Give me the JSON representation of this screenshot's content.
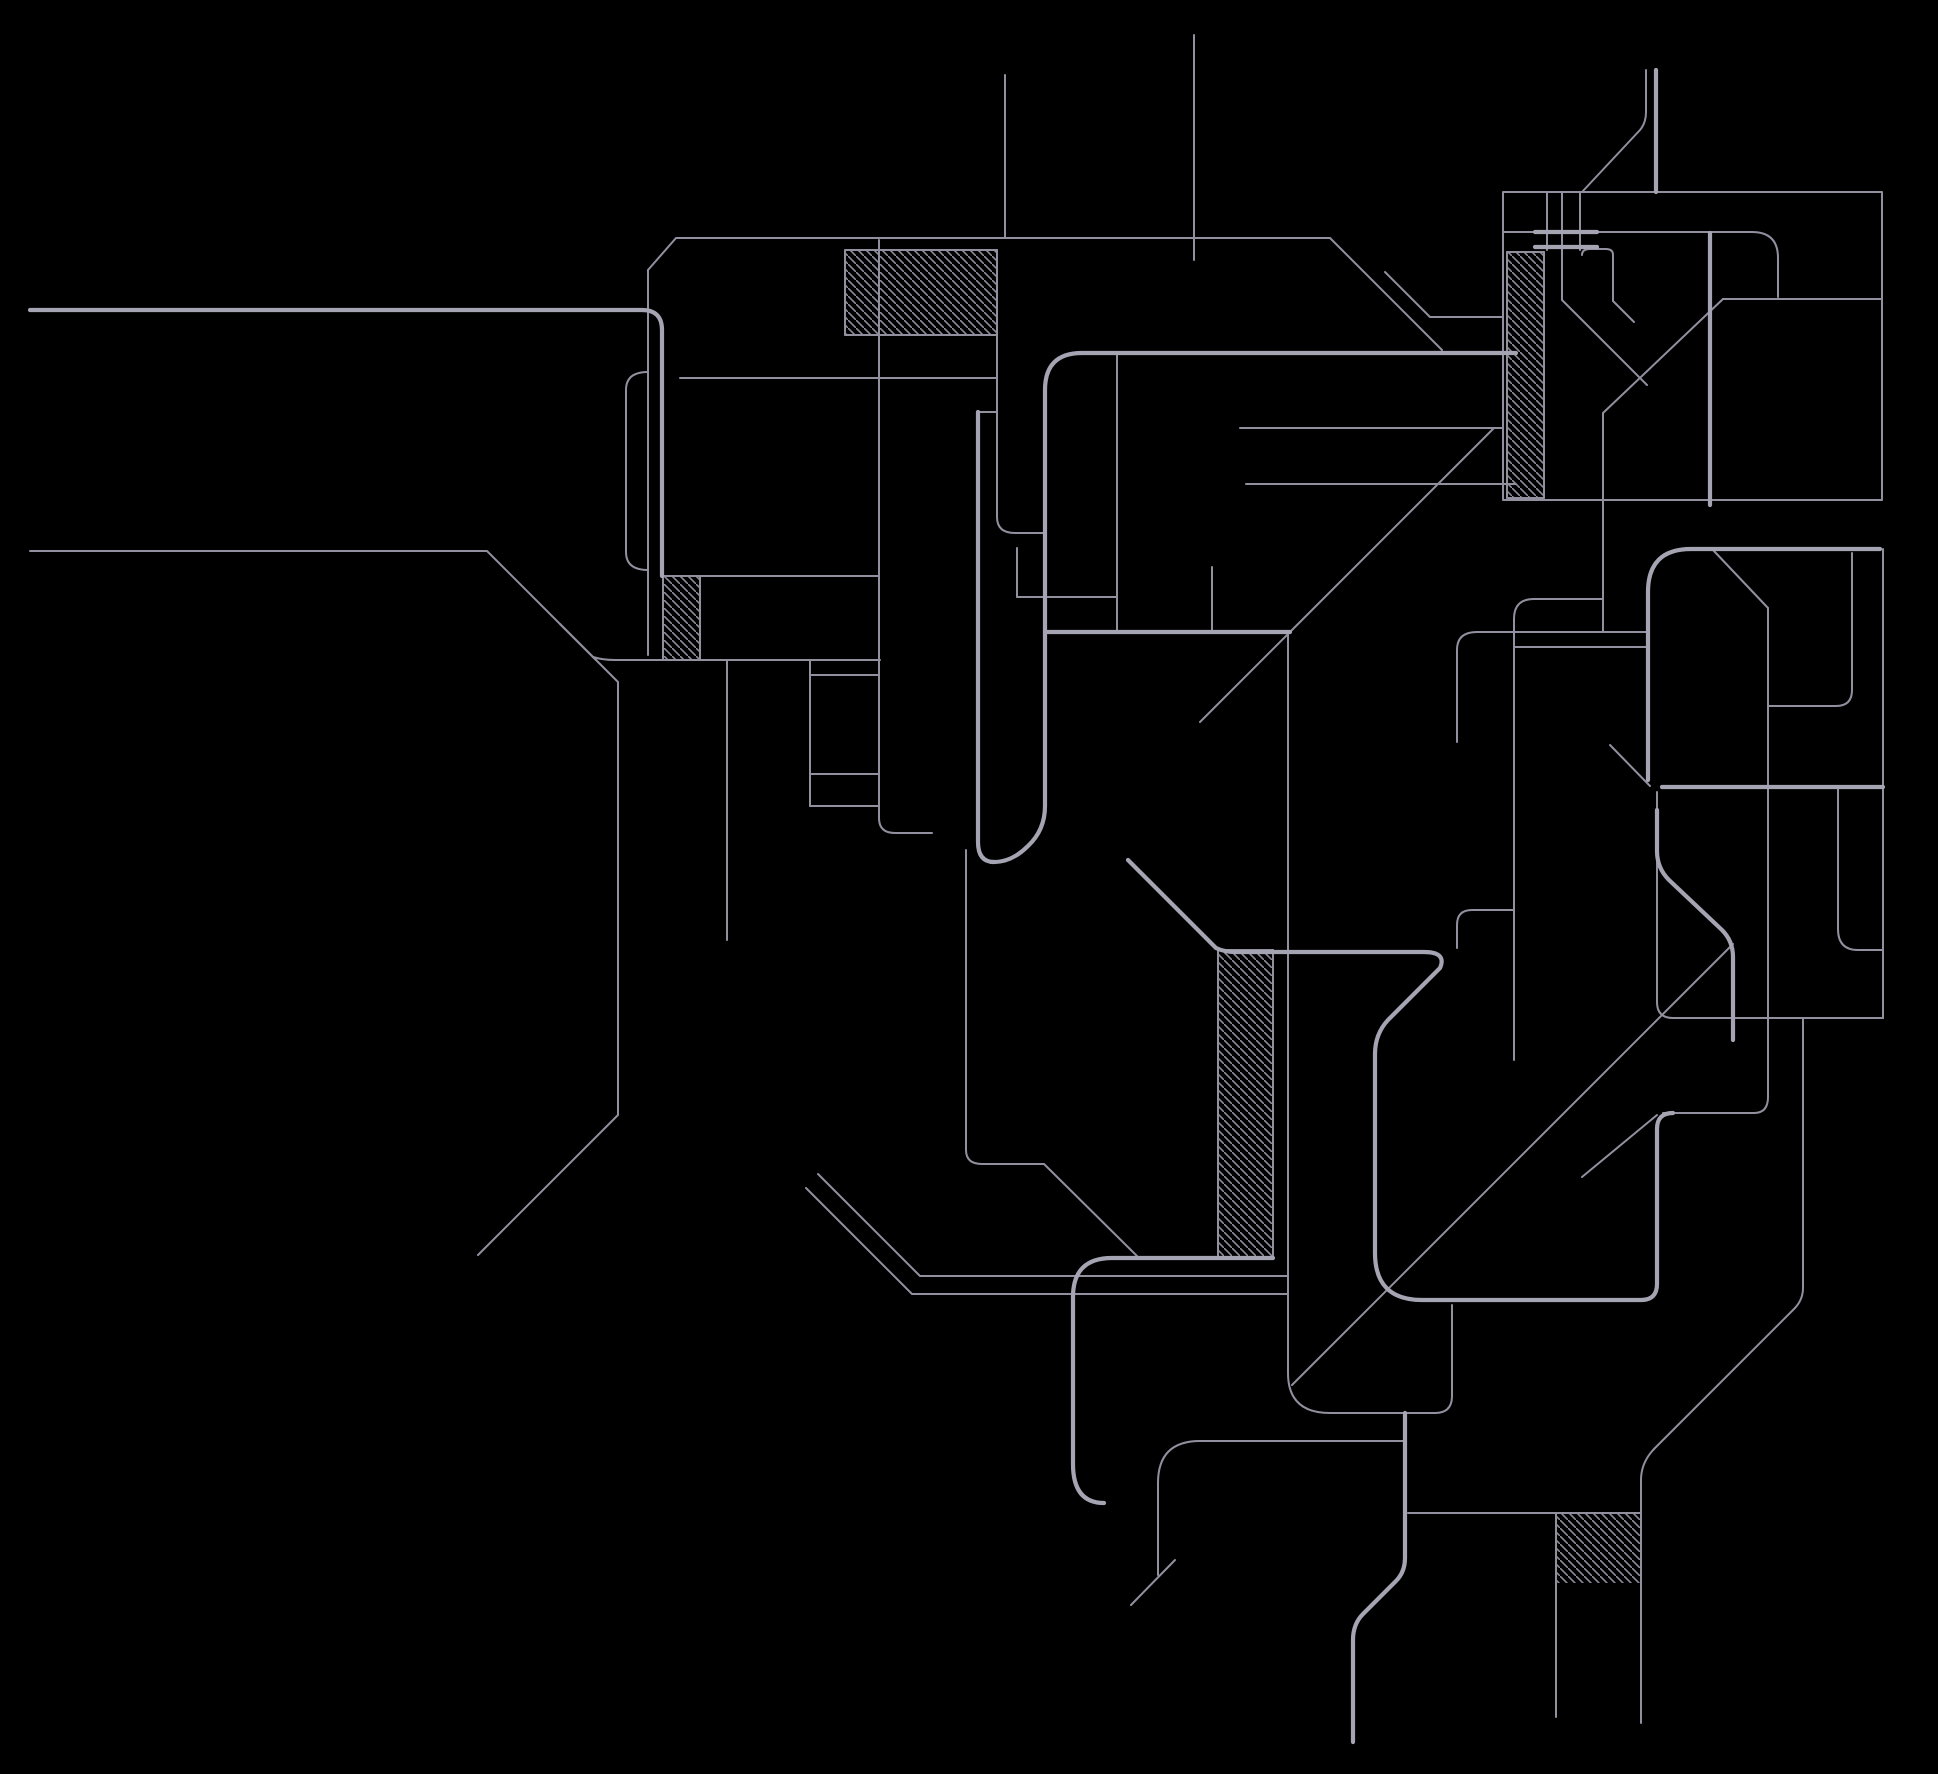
{
  "drawing": {
    "title": "untitled-technical-line-drawing",
    "canvas": {
      "width": 1938,
      "height": 1774,
      "background": "#000000"
    },
    "style": {
      "thin_color": "#92909f",
      "thin_width": 2,
      "thick_color": "#a5a4b2",
      "thick_width": 4.2,
      "hatch_color": "#8f8d9c",
      "hatch_spacing": 8,
      "hatch_line_width": 1.6,
      "hatch_direction": "backslash-45deg"
    },
    "thick_paths": [
      "M30,310 H642 Q662,310 662,330 V576",
      "M1516,353 H1082 Q1045,353 1045,390 V806 Q1045,830 1028,846 Q1012,862 994,862 Q978,862 978,842 V412",
      "M1045,632 H1290",
      "M1273,1258 H1112 Q1073,1258 1073,1297 V1464 Q1073,1503 1104,1503",
      "M1128,860 L1216,948 Q1224,952 1236,952 H1424 Q1447,952 1440,968 L1388,1020 Q1375,1034 1375,1054 V1253 Q1375,1300 1422,1300 H1641 Q1657,1300 1657,1284 V1129 Q1657,1113 1673,1113",
      "M1648,780 V592 Q1648,549 1691,549 H1880",
      "M1662,787 H1883",
      "M1657,810 V851 Q1657,868 1669,880 L1722,930 Q1733,941 1733,957 V1040",
      "M1405,1413 V1558 Q1405,1572 1396,1581 L1363,1614 Q1353,1624 1353,1640 V1742",
      "M1535,232 H1597",
      "M1535,247 H1597",
      "M1656,70 V192",
      "M1710,233 V505"
    ],
    "thin_paths": [
      "M648,270 L676,238 H1330 L1442,350",
      "M648,270 V655",
      "M648,372 Q626,372 626,390 V552 Q626,570 648,570",
      "M1005,75 V238",
      "M1194,35 V260",
      "M845,335 V250 H997",
      "M845,335 H997",
      "M997,250 V517 Q997,533 1015,533 H1043",
      "M680,378 H997",
      "M978,412 H997",
      "M30,551 H487 L596,660",
      "M560,624 L618,682 V1115 L478,1255",
      "M593,657 Q603,660 615,660 H880",
      "M663,576 H879",
      "M663,576 V660",
      "M700,576 V660",
      "M727,660 V940",
      "M810,660 V806",
      "M810,675 H879",
      "M810,774 H879",
      "M810,806 H879",
      "M879,240 V818 Q879,833 895,833 H932",
      "M966,850 V1150 Q966,1164 982,1164 H1044 L1137,1256",
      "M1017,548 V597",
      "M1017,597 H1117",
      "M1117,353 V632",
      "M1246,484 H1516",
      "M1212,567 V632",
      "M1494,428 L1290,632 L1200,722",
      "M1240,428 H1503",
      "M1218,950 V1256",
      "M1273,950 V1256",
      "M1218,950 H1273",
      "M1288,632 V1373 Q1288,1413 1330,1413 H1435 Q1452,1413 1452,1396 V1305",
      "M818,1174 L920,1276 H1288",
      "M806,1188 L912,1294 H1288",
      "M1404,1441 H1200 Q1158,1441 1158,1483 V1575",
      "M1175,1560 L1131,1605",
      "M1408,1513 H1641",
      "M1556,1513 V1717",
      "M1803,1018 V1288 Q1803,1300 1794,1309 L1655,1448 Q1641,1462 1641,1480 V1723",
      "M1733,944 L1292,1385",
      "M1657,1115 L1582,1177",
      "M1663,1113 H1754 Q1768,1113 1768,1097 V608",
      "M1713,550 L1768,608",
      "M1503,192 H1882 V500 H1503 Z",
      "M1503,232 H1752 Q1778,232 1778,258 V297",
      "M1723,299 H1882",
      "M1723,299 L1603,413 V632",
      "M1547,192 V250",
      "M1562,192 V250",
      "M1580,192 V250",
      "M1582,255 Q1582,249 1590,249 H1606 Q1613,249 1613,255 V301",
      "M1562,250 V300 L1647,385",
      "M1613,301 L1634,322",
      "M1507,252 V498",
      "M1544,252 V498",
      "M1507,252 H1544",
      "M1507,498 H1544",
      "M1385,272 L1430,317 H1503",
      "M1582,192 L1640,130 Q1646,123 1646,112 V70",
      "M1457,742 V650 Q1457,632 1477,632 H1647",
      "M1514,647 H1647",
      "M1602,599 H1534 Q1514,599 1514,619 V1060",
      "M1852,553 V690 Q1852,706 1836,706 H1768",
      "M1838,787 V929 Q1838,950 1858,950 H1883",
      "M1883,549 V1018",
      "M1657,792 V1002 Q1657,1018 1673,1018 H1883",
      "M1514,910 H1472 Q1457,910 1457,925 V948",
      "M1610,745 L1650,786"
    ],
    "hatch_regions": [
      {
        "name": "hatch-top-center",
        "x": 845,
        "y": 250,
        "w": 152,
        "h": 85
      },
      {
        "name": "hatch-left-small",
        "x": 663,
        "y": 576,
        "w": 37,
        "h": 84
      },
      {
        "name": "hatch-right-tall-bar",
        "x": 1507,
        "y": 252,
        "w": 37,
        "h": 246
      },
      {
        "name": "hatch-center-tall-bar",
        "x": 1218,
        "y": 950,
        "w": 55,
        "h": 306
      },
      {
        "name": "hatch-bottom-right",
        "x": 1556,
        "y": 1513,
        "w": 85,
        "h": 70
      }
    ]
  }
}
